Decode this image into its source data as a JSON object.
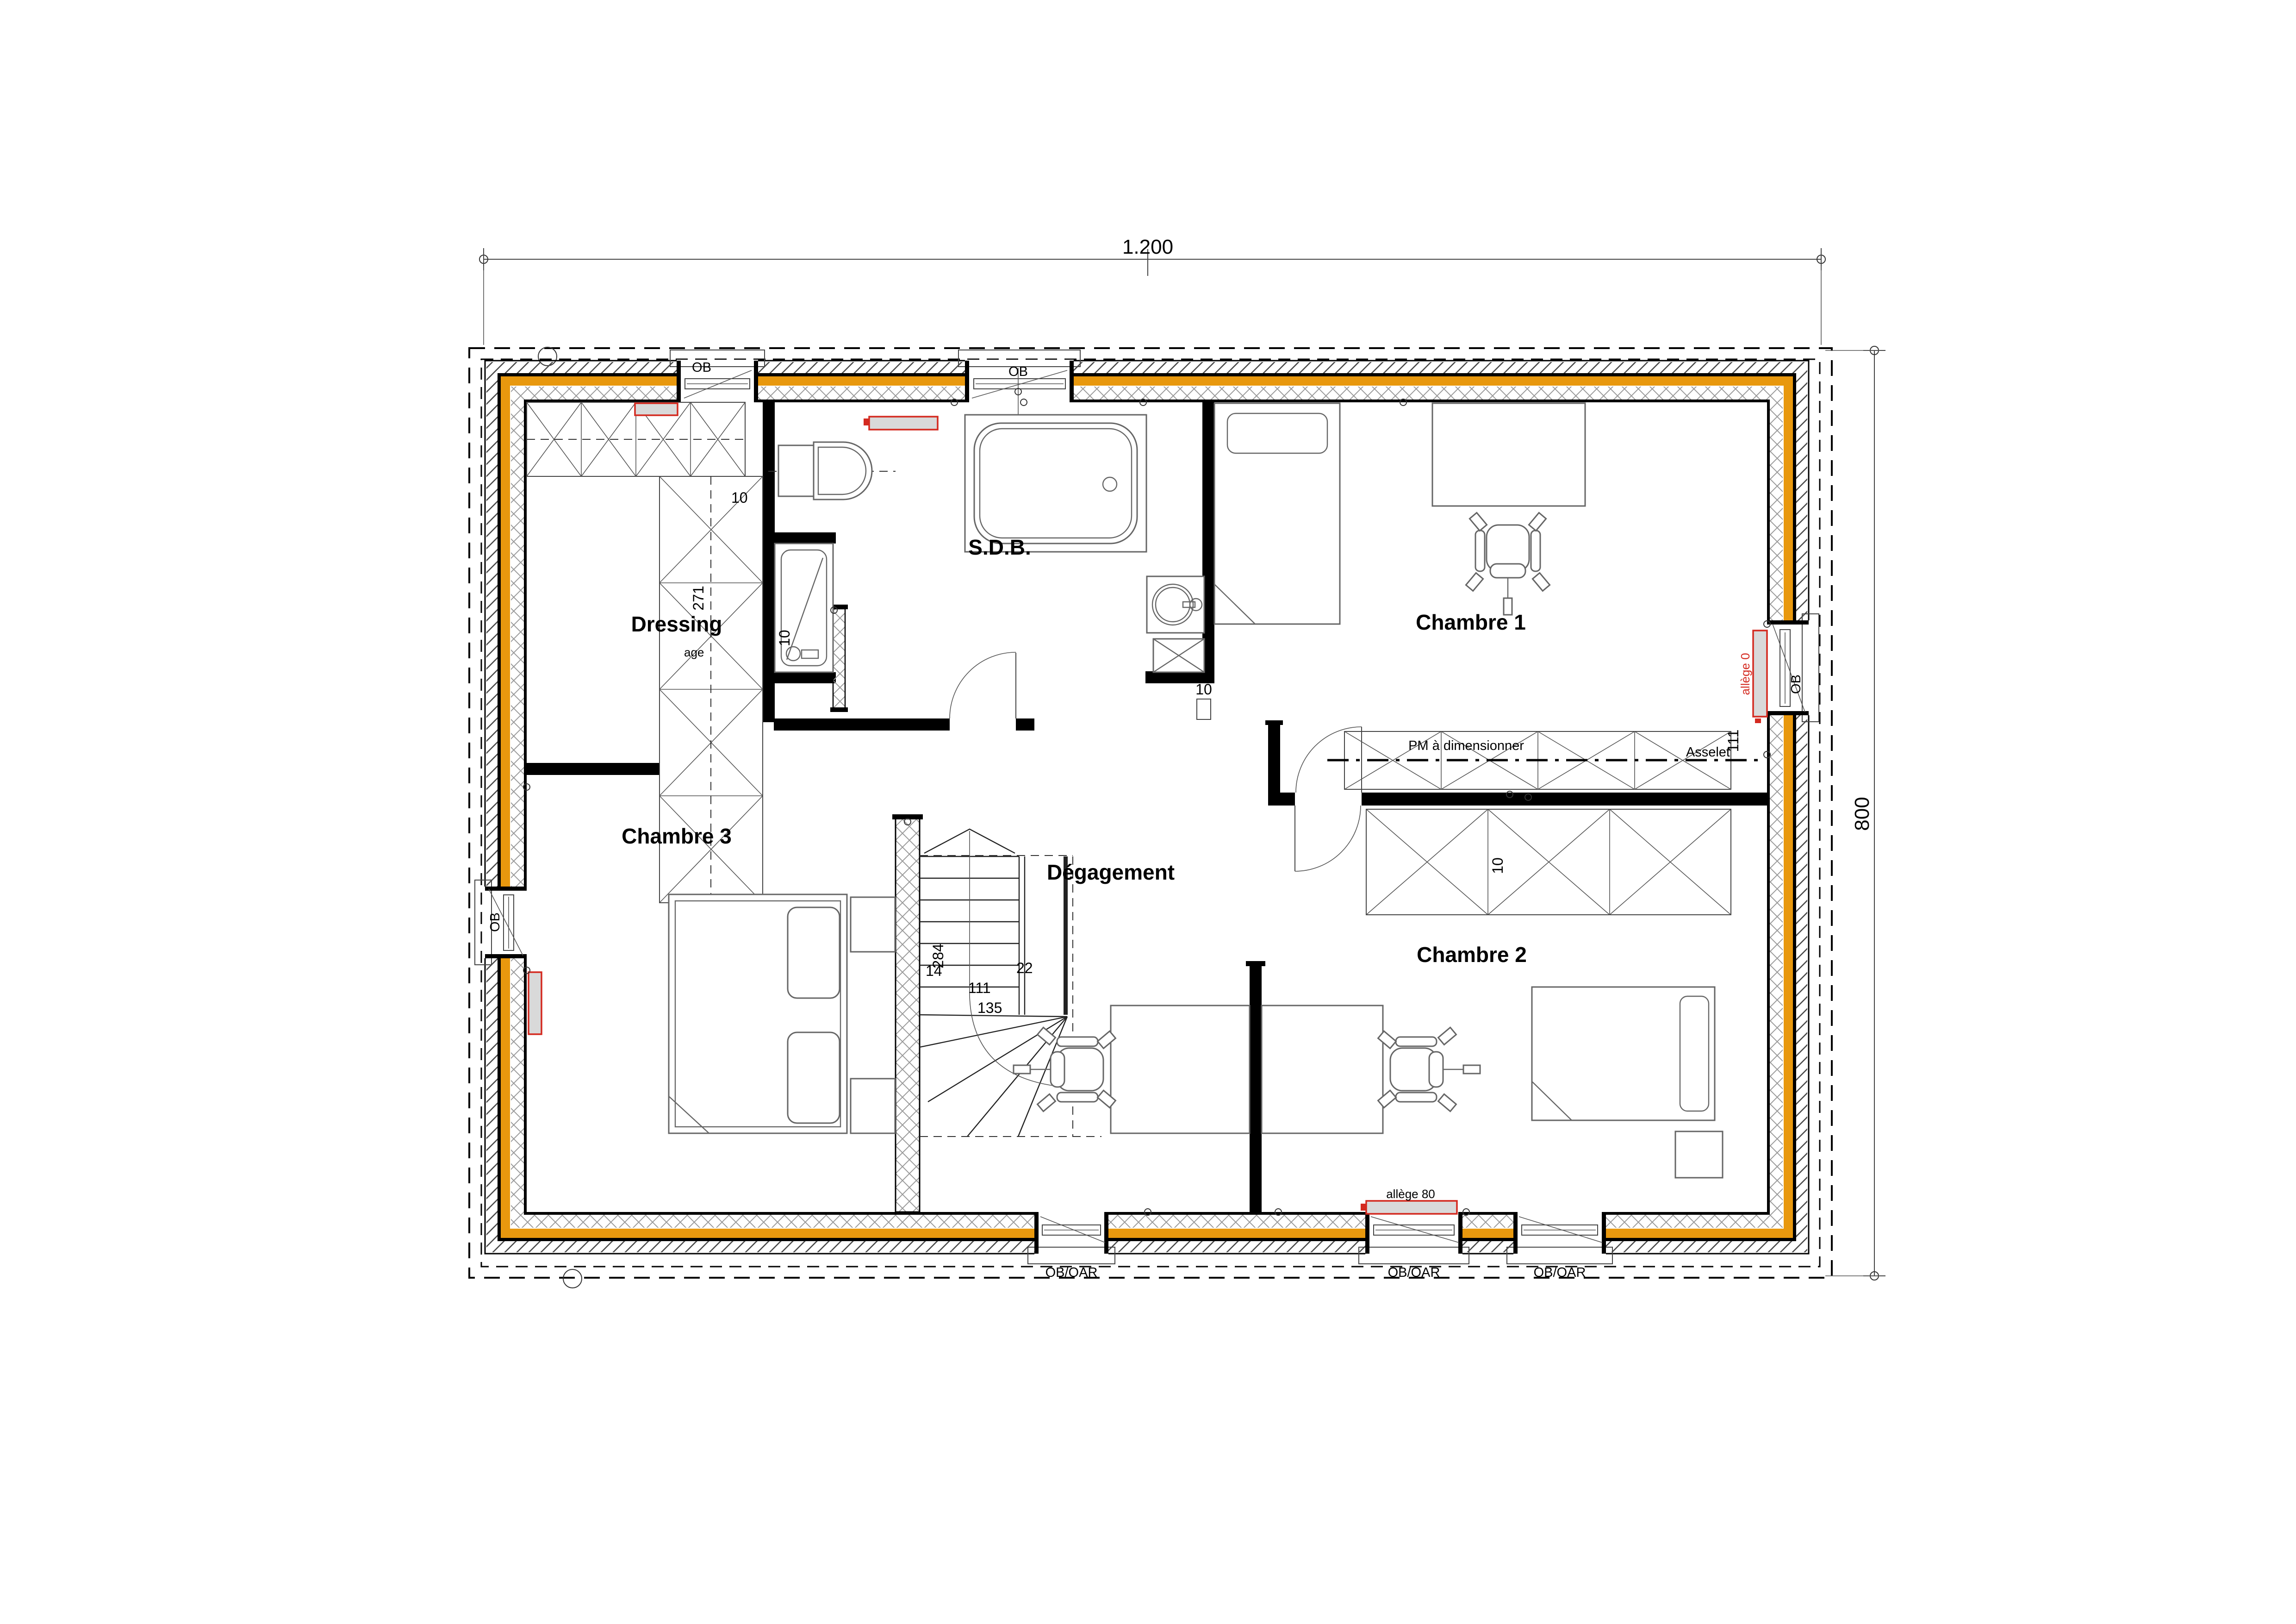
{
  "plan": {
    "dimensions": {
      "width": "1.200",
      "height": "800"
    },
    "rooms": {
      "sdb": "S.D.B.",
      "dressing": "Dressing",
      "chambre1": "Chambre 1",
      "chambre2": "Chambre 2",
      "chambre3": "Chambre 3",
      "degagement": "Dégagement"
    },
    "windows": {
      "top1": "OB",
      "top2": "OB",
      "left": "OB",
      "right": "OB",
      "bottom1": "OB/OAR",
      "bottom2": "OB/OAR",
      "bottom3": "OB/OAR"
    },
    "annotations": {
      "allege80_top": "allège 80",
      "allege80_bottom": "allège 80",
      "allege0_right": "allège 0",
      "pm": "PM à dimensionner",
      "asselet": "Asselet",
      "w111": "111",
      "w10": "10",
      "d10": "10",
      "d271": "271",
      "age": "age",
      "door10": "10",
      "s14": "14",
      "s284": "284",
      "s111": "111",
      "s135": "135",
      "s22": "22"
    },
    "colors": {
      "orange": "#E8980E",
      "red": "#D42A20",
      "radiator_fill": "#D9D9D9",
      "furniture": "#666666",
      "hatch": "#4a4a4a",
      "insul": "#9a9a9a",
      "line": "#000000"
    }
  }
}
